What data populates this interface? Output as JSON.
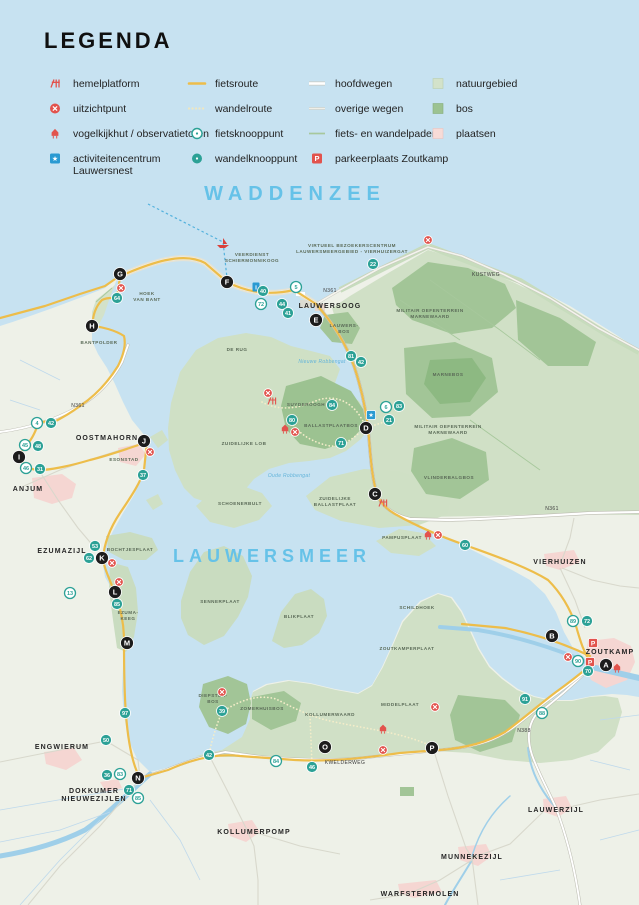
{
  "legend": {
    "title": "LEGENDA",
    "columns": [
      {
        "x": 44,
        "items": [
          {
            "icon": "hemelplatform-icon",
            "label": "hemelplatform"
          },
          {
            "icon": "uitzichtpunt-icon",
            "label": "uitzichtpunt"
          },
          {
            "icon": "vogelkijkhut-icon",
            "label": "vogelkijkhut / observatietoren"
          },
          {
            "icon": "activiteitencentrum-icon",
            "label": "activiteitencentrum",
            "label2": "Lauwersnest"
          }
        ]
      },
      {
        "x": 186,
        "items": [
          {
            "icon": "fietsroute-icon",
            "label": "fietsroute"
          },
          {
            "icon": "wandelroute-icon",
            "label": "wandelroute"
          },
          {
            "icon": "fietsknooppunt-icon",
            "label": "fietsknooppunt"
          },
          {
            "icon": "wandelknooppunt-icon",
            "label": "wandelknooppunt"
          }
        ]
      },
      {
        "x": 306,
        "items": [
          {
            "icon": "hoofdwegen-icon",
            "label": "hoofdwegen"
          },
          {
            "icon": "overige-wegen-icon",
            "label": "overige wegen"
          },
          {
            "icon": "fiets-wandelpaden-icon",
            "label": "fiets- en wandelpaden"
          },
          {
            "icon": "parkeerplaats-icon",
            "label": "parkeerplaats Zoutkamp"
          }
        ]
      },
      {
        "x": 427,
        "items": [
          {
            "icon": "natuurgebied-icon",
            "label": "natuurgebied"
          },
          {
            "icon": "bos-icon",
            "label": "bos"
          },
          {
            "icon": "plaatsen-icon",
            "label": "plaatsen"
          }
        ]
      }
    ]
  },
  "map": {
    "colors": {
      "sea": "#c7e2f1",
      "land": "#eef1e8",
      "natuur": "#d0e0c6",
      "bos": "#a2c597",
      "bos_donker": "#8db982",
      "plaatsen": "#f5d6d2",
      "fietsroute": "#edbd4a",
      "wandelroute": "#f4edc9",
      "knooppunt": "#2ca196",
      "marker": "#1c1c1c",
      "poi_rood": "#e2534d",
      "poi_blauw": "#2a9ad2",
      "water_label": "#66c2e8"
    },
    "water_labels": [
      {
        "text": "WADDENZEE",
        "x": 295,
        "y": 200,
        "size": 20,
        "spacing": 6
      },
      {
        "text": "LAUWERSMEER",
        "x": 272,
        "y": 562,
        "size": 18,
        "spacing": 5
      },
      {
        "text": "Nieuwe Robbengat",
        "x": 322,
        "y": 363,
        "size": 5,
        "italic": true
      },
      {
        "text": "Oude Robbengat",
        "x": 289,
        "y": 477,
        "size": 5,
        "italic": true
      }
    ],
    "place_labels": [
      {
        "text": "LAUWERSOOG",
        "x": 330,
        "y": 308
      },
      {
        "text": "OOSTMAHORN",
        "x": 107,
        "y": 440
      },
      {
        "text": "ANJUM",
        "x": 28,
        "y": 491
      },
      {
        "text": "EZUMAZIJL",
        "x": 62,
        "y": 553
      },
      {
        "text": "ENGWIERUM",
        "x": 62,
        "y": 749
      },
      {
        "lines": [
          "DOKKUMER",
          "NIEUWEZIJLEN"
        ],
        "x": 94,
        "y": 793
      },
      {
        "text": "KOLLUMERPOMP",
        "x": 254,
        "y": 834
      },
      {
        "text": "VIERHUIZEN",
        "x": 560,
        "y": 564
      },
      {
        "text": "ZOUTKAMP",
        "x": 610,
        "y": 654
      },
      {
        "text": "LAUWERZIJL",
        "x": 556,
        "y": 812
      },
      {
        "text": "MUNNEKEZIJL",
        "x": 472,
        "y": 859
      },
      {
        "text": "WARFSTERMOLEN",
        "x": 420,
        "y": 896
      }
    ],
    "area_labels": [
      {
        "lines": [
          "HOEK",
          "VAN BANT"
        ],
        "x": 147,
        "y": 295
      },
      {
        "text": "BANTPOLDER",
        "x": 99,
        "y": 344
      },
      {
        "text": "ESONSTAD",
        "x": 124,
        "y": 461
      },
      {
        "text": "BOCHTJESPLAAT",
        "x": 130,
        "y": 551
      },
      {
        "lines": [
          "EZUMA-",
          "KEEG"
        ],
        "x": 128,
        "y": 614
      },
      {
        "text": "DE RUG",
        "x": 237,
        "y": 351
      },
      {
        "text": "SENNERPLAAT",
        "x": 220,
        "y": 603
      },
      {
        "text": "BLIKPLAAT",
        "x": 299,
        "y": 618
      },
      {
        "text": "SCHILDHOEK",
        "x": 417,
        "y": 609
      },
      {
        "text": "ZOUTKAMPERPLAAT",
        "x": 407,
        "y": 650
      },
      {
        "text": "ZUIDELIJKE LOB",
        "x": 244,
        "y": 445
      },
      {
        "text": "SCHOENERBULT",
        "x": 240,
        "y": 505
      },
      {
        "lines": [
          "ZUIDELIJKE",
          "BALLASTPLAAT"
        ],
        "x": 335,
        "y": 500
      },
      {
        "text": "PAMPUSPLAAT",
        "x": 402,
        "y": 539
      },
      {
        "text": "SUYDEROOGH",
        "x": 306,
        "y": 406
      },
      {
        "text": "BALLASTPLAATBOS",
        "x": 331,
        "y": 427
      },
      {
        "lines": [
          "LAUWERS-",
          "BOS"
        ],
        "x": 344,
        "y": 327
      },
      {
        "lines": [
          "MILITAIR OEFENTERREIN",
          "MARNEWAARD"
        ],
        "x": 430,
        "y": 312
      },
      {
        "lines": [
          "MILITAIR OEFENTERREIN",
          "MARNEWAARD"
        ],
        "x": 448,
        "y": 428
      },
      {
        "text": "VLINDERBALGBOS",
        "x": 449,
        "y": 479
      },
      {
        "text": "MARNEBOS",
        "x": 448,
        "y": 376
      },
      {
        "lines": [
          "DIEPSTER-",
          "BOS"
        ],
        "x": 213,
        "y": 697
      },
      {
        "text": "ZOMERHUISBOS",
        "x": 262,
        "y": 710
      },
      {
        "text": "KOLLUMERWAARD",
        "x": 330,
        "y": 716
      },
      {
        "text": "MIDDELPLAAT",
        "x": 400,
        "y": 706
      },
      {
        "lines": [
          "VEERDIENST",
          "SCHIERMONNIKOOG"
        ],
        "x": 252,
        "y": 256
      },
      {
        "lines": [
          "VIRTUEEL BEZOEKERSCENTRUM",
          "LAUWERSMEERGEBIED - VIERHUIZERGAT"
        ],
        "x": 352,
        "y": 247
      }
    ],
    "road_labels": [
      {
        "text": "N361",
        "x": 78,
        "y": 407
      },
      {
        "text": "N361",
        "x": 330,
        "y": 292
      },
      {
        "text": "N361",
        "x": 552,
        "y": 510
      },
      {
        "text": "N388",
        "x": 524,
        "y": 732
      },
      {
        "text": "KWELDERWEG",
        "x": 345,
        "y": 764
      },
      {
        "text": "KUSTWEG",
        "x": 486,
        "y": 276
      }
    ],
    "letter_markers": [
      {
        "letter": "A",
        "x": 606,
        "y": 665
      },
      {
        "letter": "B",
        "x": 552,
        "y": 636
      },
      {
        "letter": "C",
        "x": 375,
        "y": 494
      },
      {
        "letter": "D",
        "x": 366,
        "y": 428
      },
      {
        "letter": "E",
        "x": 316,
        "y": 320
      },
      {
        "letter": "F",
        "x": 227,
        "y": 282
      },
      {
        "letter": "G",
        "x": 120,
        "y": 274
      },
      {
        "letter": "H",
        "x": 92,
        "y": 326
      },
      {
        "letter": "I",
        "x": 19,
        "y": 457
      },
      {
        "letter": "J",
        "x": 144,
        "y": 441
      },
      {
        "letter": "K",
        "x": 102,
        "y": 558
      },
      {
        "letter": "L",
        "x": 115,
        "y": 592
      },
      {
        "letter": "M",
        "x": 127,
        "y": 643
      },
      {
        "letter": "N",
        "x": 138,
        "y": 778
      },
      {
        "letter": "O",
        "x": 325,
        "y": 747
      },
      {
        "letter": "P",
        "x": 432,
        "y": 748
      }
    ],
    "fietsknooppunten": [
      {
        "n": "4",
        "x": 37,
        "y": 423
      },
      {
        "n": "45",
        "x": 25,
        "y": 445
      },
      {
        "n": "46",
        "x": 26,
        "y": 468
      },
      {
        "n": "13",
        "x": 70,
        "y": 593
      },
      {
        "n": "5",
        "x": 296,
        "y": 287
      },
      {
        "n": "72",
        "x": 261,
        "y": 304
      },
      {
        "n": "6",
        "x": 386,
        "y": 407
      },
      {
        "n": "89",
        "x": 573,
        "y": 621
      },
      {
        "n": "90",
        "x": 578,
        "y": 661
      },
      {
        "n": "88",
        "x": 542,
        "y": 713
      },
      {
        "n": "84",
        "x": 276,
        "y": 761
      },
      {
        "n": "83",
        "x": 120,
        "y": 774
      },
      {
        "n": "85",
        "x": 138,
        "y": 798
      }
    ],
    "wandelknooppunten": [
      {
        "n": "42",
        "x": 51,
        "y": 423
      },
      {
        "n": "48",
        "x": 38,
        "y": 446
      },
      {
        "n": "31",
        "x": 40,
        "y": 469
      },
      {
        "n": "37",
        "x": 143,
        "y": 475
      },
      {
        "n": "53",
        "x": 95,
        "y": 546
      },
      {
        "n": "62",
        "x": 89,
        "y": 558
      },
      {
        "n": "85",
        "x": 117,
        "y": 604
      },
      {
        "n": "97",
        "x": 125,
        "y": 713
      },
      {
        "n": "50",
        "x": 106,
        "y": 740
      },
      {
        "n": "36",
        "x": 107,
        "y": 775
      },
      {
        "n": "71",
        "x": 129,
        "y": 790
      },
      {
        "n": "42",
        "x": 209,
        "y": 755
      },
      {
        "n": "46",
        "x": 312,
        "y": 767
      },
      {
        "n": "39",
        "x": 222,
        "y": 711
      },
      {
        "n": "64",
        "x": 117,
        "y": 298
      },
      {
        "n": "40",
        "x": 263,
        "y": 291
      },
      {
        "n": "44",
        "x": 282,
        "y": 304
      },
      {
        "n": "41",
        "x": 288,
        "y": 313
      },
      {
        "n": "22",
        "x": 373,
        "y": 264
      },
      {
        "n": "81",
        "x": 351,
        "y": 356
      },
      {
        "n": "42",
        "x": 361,
        "y": 362
      },
      {
        "n": "84",
        "x": 332,
        "y": 405
      },
      {
        "n": "80",
        "x": 292,
        "y": 420
      },
      {
        "n": "71",
        "x": 341,
        "y": 443
      },
      {
        "n": "83",
        "x": 399,
        "y": 406
      },
      {
        "n": "21",
        "x": 389,
        "y": 420
      },
      {
        "n": "60",
        "x": 465,
        "y": 545
      },
      {
        "n": "72",
        "x": 587,
        "y": 621
      },
      {
        "n": "70",
        "x": 588,
        "y": 671
      },
      {
        "n": "91",
        "x": 525,
        "y": 699
      }
    ],
    "pois": [
      {
        "type": "uitzichtpunt",
        "x": 121,
        "y": 288
      },
      {
        "type": "uitzichtpunt",
        "x": 150,
        "y": 452
      },
      {
        "type": "uitzichtpunt",
        "x": 112,
        "y": 563
      },
      {
        "type": "uitzichtpunt",
        "x": 119,
        "y": 582
      },
      {
        "type": "uitzichtpunt",
        "x": 428,
        "y": 240
      },
      {
        "type": "uitzichtpunt",
        "x": 568,
        "y": 657
      },
      {
        "type": "uitzichtpunt",
        "x": 435,
        "y": 707
      },
      {
        "type": "uitzichtpunt",
        "x": 383,
        "y": 750
      },
      {
        "type": "uitzichtpunt",
        "x": 268,
        "y": 393
      },
      {
        "type": "uitzichtpunt",
        "x": 295,
        "y": 432
      },
      {
        "type": "uitzichtpunt",
        "x": 222,
        "y": 692
      },
      {
        "type": "uitzichtpunt",
        "x": 438,
        "y": 535
      },
      {
        "type": "vogelkijkhut",
        "x": 285,
        "y": 429
      },
      {
        "type": "vogelkijkhut",
        "x": 383,
        "y": 729
      },
      {
        "type": "vogelkijkhut",
        "x": 428,
        "y": 535
      },
      {
        "type": "vogelkijkhut",
        "x": 617,
        "y": 668
      },
      {
        "type": "hemelplatform",
        "x": 272,
        "y": 401
      },
      {
        "type": "hemelplatform",
        "x": 383,
        "y": 503
      },
      {
        "type": "activiteitencentrum",
        "x": 371,
        "y": 415
      },
      {
        "type": "informatie",
        "x": 256,
        "y": 287
      },
      {
        "type": "parkeerplaats",
        "x": 593,
        "y": 643
      },
      {
        "type": "parkeerplaats",
        "x": 590,
        "y": 662
      },
      {
        "type": "veerboot",
        "x": 223,
        "y": 243
      }
    ]
  }
}
